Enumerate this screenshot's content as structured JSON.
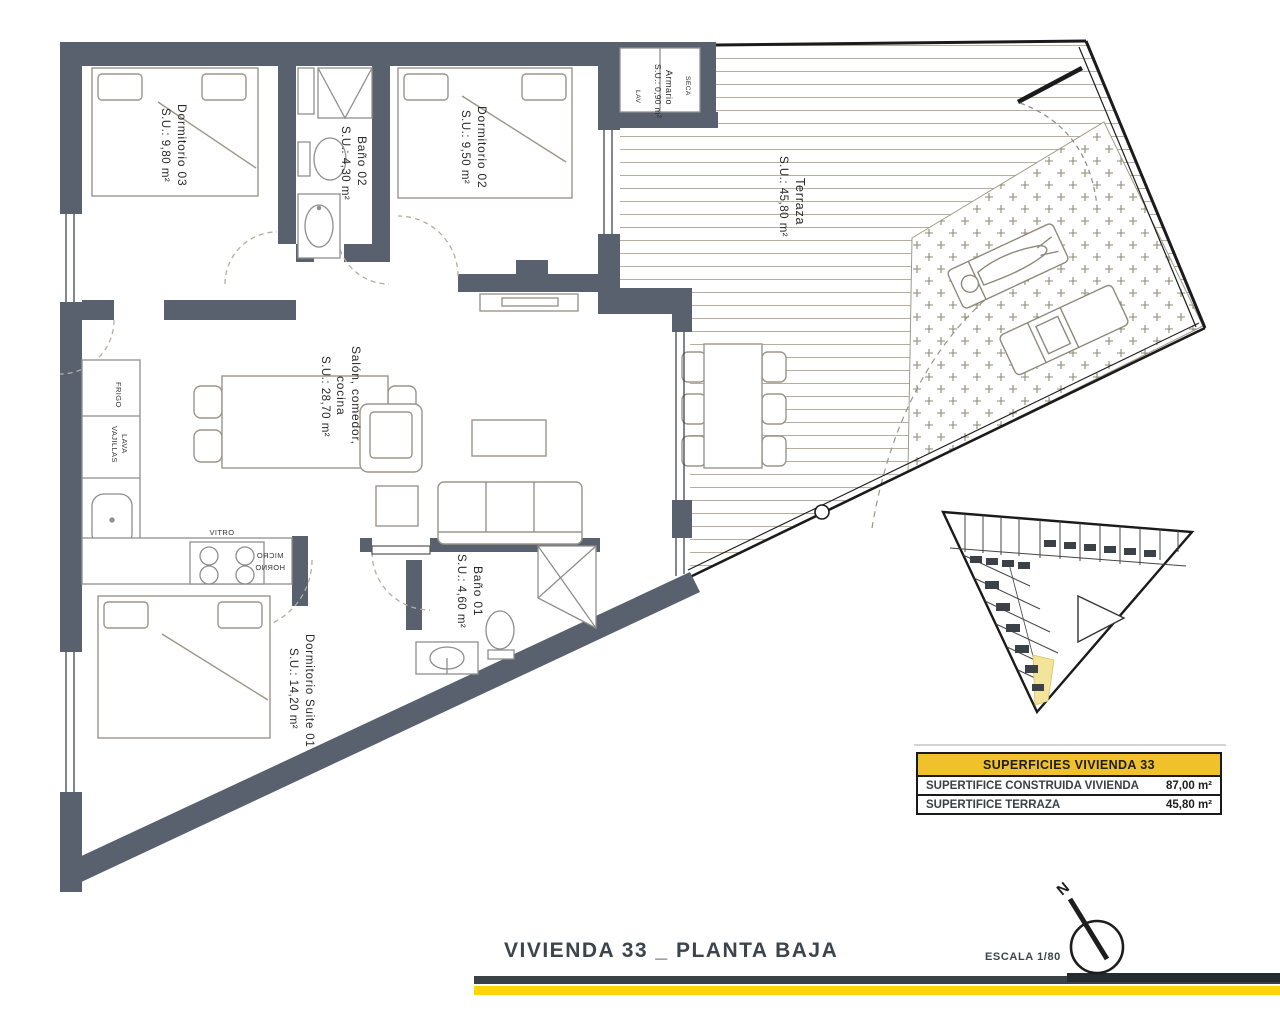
{
  "title_block": {
    "title": "VIVIENDA 33 _ PLANTA BAJA",
    "scale_label": "ESCALA 1/80",
    "north_label": "N"
  },
  "rooms": {
    "dormitorio_03": {
      "name": "Dormitorio 03",
      "area": "S.U.: 9,80 m²"
    },
    "bano_02": {
      "name": "Baño 02",
      "area": "S.U.: 4,30 m²"
    },
    "dormitorio_02": {
      "name": "Dormitorio 02",
      "area": "S.U.: 9,50 m²"
    },
    "armario": {
      "name": "Armario",
      "area": "S.U.: 0,90 m²"
    },
    "terraza": {
      "name": "Terraza",
      "area": "S.U.: 45,80 m²"
    },
    "salon": {
      "name_line1": "Salón, comedor,",
      "name_line2": "cocina",
      "area": "S.U.: 28,70 m²"
    },
    "bano_01": {
      "name": "Baño 01",
      "area": "S.U.: 4,60 m²"
    },
    "suite_01": {
      "name": "Dormitorio Suite 01",
      "area": "S.U.: 14,20 m²"
    }
  },
  "appliances": {
    "fridge": "FRIGO",
    "dishwasher_line1": "LAVA",
    "dishwasher_line2": "VAJILLAS",
    "hob": "VITRO",
    "microwave": "MICRO",
    "oven": "HORNO",
    "washer": "LAV",
    "dryer": "SECA"
  },
  "summary_table": {
    "header": "SUPERFICIES VIVIENDA 33",
    "rows": [
      {
        "label": "SUPERTIFICE CONSTRUIDA VIVIENDA",
        "value": "87,00 m²"
      },
      {
        "label": "SUPERTIFICE TERRAZA",
        "value": "45,80 m²"
      }
    ]
  },
  "colors": {
    "wall": "#59616F",
    "accent_yellow": "#FFD60B",
    "table_header_yellow": "#F1C12B",
    "bar_dark": "#3A4147",
    "unit_highlight": "#F3E49B"
  }
}
